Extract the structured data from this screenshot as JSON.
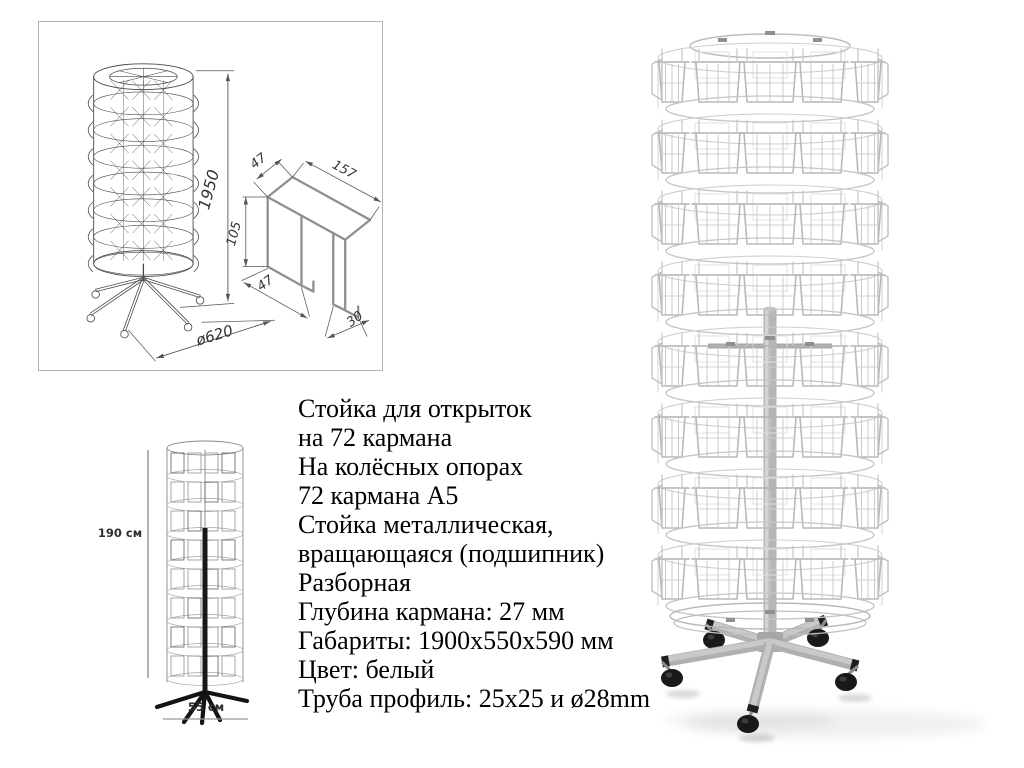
{
  "product": {
    "spec_lines": [
      "Стойка для открыток",
      "на 72 кармана",
      "На колёсных опорах",
      "72 кармана А5",
      "Стойка металлическая,",
      "вращающаяся (подшипник)",
      "Разборная",
      "Глубина кармана: 27 мм",
      "Габариты: 1900х550х590 мм",
      "Цвет: белый",
      "Труба профиль: 25х25 и ø28mm"
    ]
  },
  "technical_drawing": {
    "height_label": "1950",
    "base_diameter_label": "ø620",
    "pocket_profile": {
      "top_width_label": "47",
      "top_length_label": "157",
      "side_height_label": "105",
      "bottom_width_label": "47",
      "hook_width_label": "30"
    }
  },
  "scale_drawing": {
    "height_label": "190 см",
    "width_label": "55 см"
  },
  "colors": {
    "background": "#ffffff",
    "panel_border": "#b3b3b3",
    "drawing_line": "#4a4a4a",
    "dimension_line": "#555555",
    "profile_line": "#8f8f8f",
    "wire": "#c4c4c4",
    "pole": "#b5b5b5",
    "base_metal": "#b0b0b0",
    "wheel": "#191919",
    "text": "#000000"
  }
}
